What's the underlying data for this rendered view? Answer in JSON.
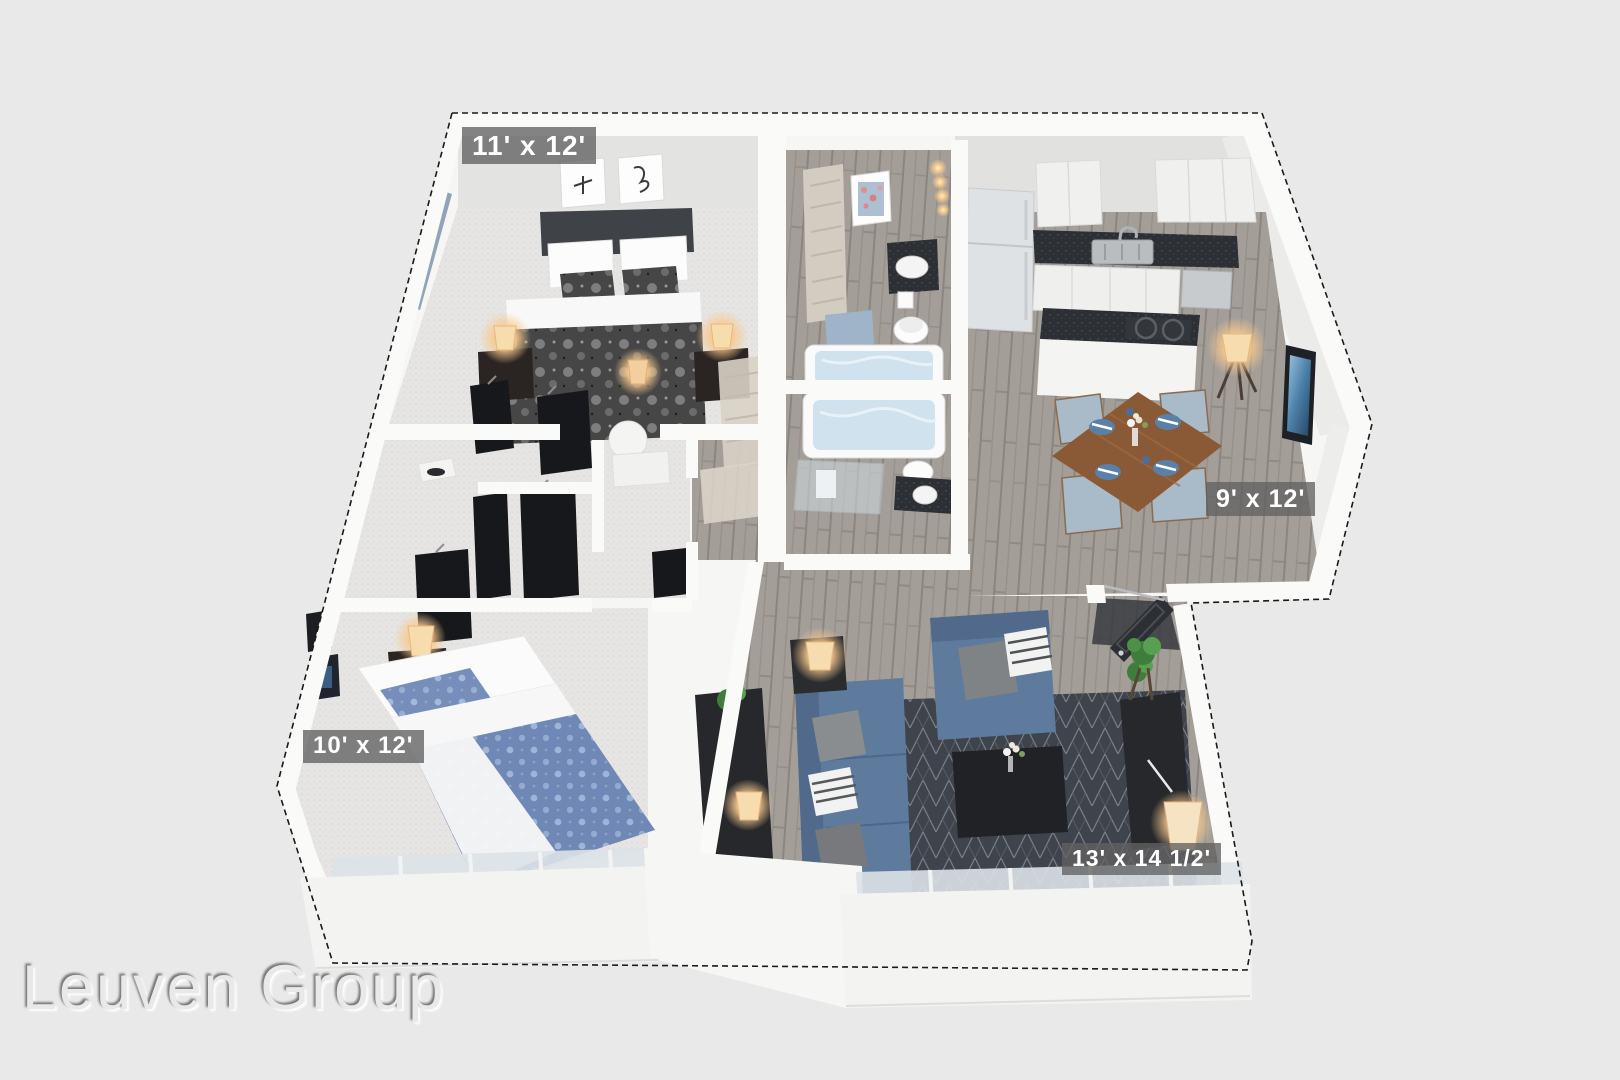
{
  "palette": {
    "bg": "#e8e9e8",
    "label-bg": "rgba(97,97,97,0.78)",
    "label-text": "#ffffff",
    "wall": "#f6f6f5",
    "carpet": "#e6e5e3",
    "wood": "#a49e99",
    "rug": "#3f434b",
    "sofa-blue": "#5e7b9d",
    "duvet-blue": "#6f88b6",
    "dining-table-wood": "#8a5a36",
    "lamp-glow": "#f8c98e"
  },
  "watermark": {
    "text": "Leuven Group"
  },
  "floorplan": {
    "view": "3D isometric apartment floor plan",
    "rooms": [
      {
        "id": "bedroom-1",
        "label": "11' x 12'"
      },
      {
        "id": "dining-area",
        "label": "9' x 12'"
      },
      {
        "id": "bedroom-2",
        "label": "10' x 12'"
      },
      {
        "id": "living-room",
        "label": "13' x 14 1/2'"
      }
    ]
  }
}
